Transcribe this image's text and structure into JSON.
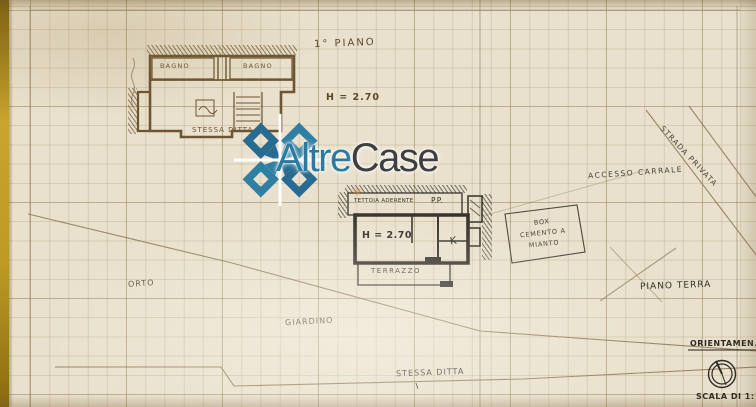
{
  "watermark": {
    "brand_first": "Altre",
    "brand_second": "Case",
    "logo_color_primary": "#276b91",
    "logo_color_secondary": "#2f7fa3",
    "text_color_first": "#2b7aa0",
    "text_color_second": "#3f3e40"
  },
  "plan_upper": {
    "title": "1° PIANO",
    "room_left": "BAGNO",
    "room_right": "BAGNO",
    "height_note": "H = 2.70",
    "caption": "STESSA DITTA"
  },
  "plan_ground": {
    "roof_label": "TETTOIA ADERENTE",
    "roof_abbrev": "P.P.",
    "height_note": "H = 2.70",
    "kitchen_label": "K",
    "terrace_label": "TERRAZZO"
  },
  "site": {
    "box_label_line1": "BOX",
    "box_label_line2": "CEMENTO A",
    "box_label_line3": "MIANTO",
    "access_label": "ACCESSO CARRALE",
    "road_label": "STRADA PRIVATA",
    "orto_label": "ORTO",
    "garden_label": "GIARDINO",
    "ground_floor_label": "PIANO TERRA",
    "neighbor_label": "STESSA DITTA"
  },
  "title_block": {
    "orientation_label": "ORIENTAMEN.",
    "scale_label": "SCALA DI 1:",
    "compass_icon": "compass"
  },
  "colors": {
    "paper": "#e9e1cd",
    "ink_sepia": "#6e5430",
    "ink_black": "#34302a",
    "grid": "#927e58",
    "edge_gold": "#c9a42e"
  }
}
